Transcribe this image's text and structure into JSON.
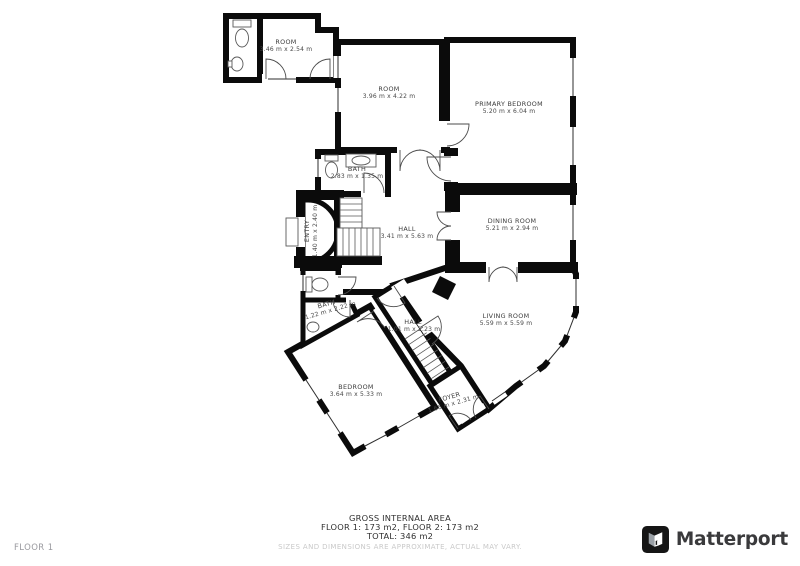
{
  "floorplan": {
    "rooms": [
      {
        "id": "annex-room",
        "name": "ROOM",
        "dims": "3.46 m x 2.54 m"
      },
      {
        "id": "room-upper",
        "name": "ROOM",
        "dims": "3.96 m x 4.22 m"
      },
      {
        "id": "primary-bedroom",
        "name": "PRIMARY BEDROOM",
        "dims": "5.20 m x 6.04 m"
      },
      {
        "id": "bath-upper",
        "name": "BATH",
        "dims": "2.83 m x 1.35 m"
      },
      {
        "id": "entry",
        "name": "ENTRY",
        "dims": "1.40 m x 2.40 m"
      },
      {
        "id": "hall-main",
        "name": "HALL",
        "dims": "3.41 m x 5.63 m"
      },
      {
        "id": "dining-room",
        "name": "DINING ROOM",
        "dims": "5.21 m x 2.94 m"
      },
      {
        "id": "living-room",
        "name": "LIVING ROOM",
        "dims": "5.59 m x 5.59 m"
      },
      {
        "id": "bath-lower",
        "name": "BATH",
        "dims": "1.22 m x 2.22 m"
      },
      {
        "id": "hall-lower",
        "name": "HALL",
        "dims": "1.01 m x 2.23 m"
      },
      {
        "id": "bedroom",
        "name": "BEDROOM",
        "dims": "3.64 m x 5.33 m"
      },
      {
        "id": "foyer",
        "name": "FOYER",
        "dims": "1.66 m x 2.31 m"
      }
    ],
    "footer": {
      "area_title": "GROSS INTERNAL AREA",
      "floors_line": "FLOOR 1: 173 m2, FLOOR 2: 173 m2",
      "total_line": "TOTAL: 346 m2",
      "disclaimer": "SIZES AND DIMENSIONS ARE APPROXIMATE, ACTUAL MAY VARY."
    },
    "floor_label": "FLOOR 1",
    "brand": {
      "name": "Matterport"
    },
    "colors": {
      "wall": "#0b0b0b",
      "label_text": "#3c3c3c",
      "muted_text": "#c9c9c9",
      "floor_label_text": "#9a9a9f",
      "brand_text": "#3a3a3c"
    }
  }
}
